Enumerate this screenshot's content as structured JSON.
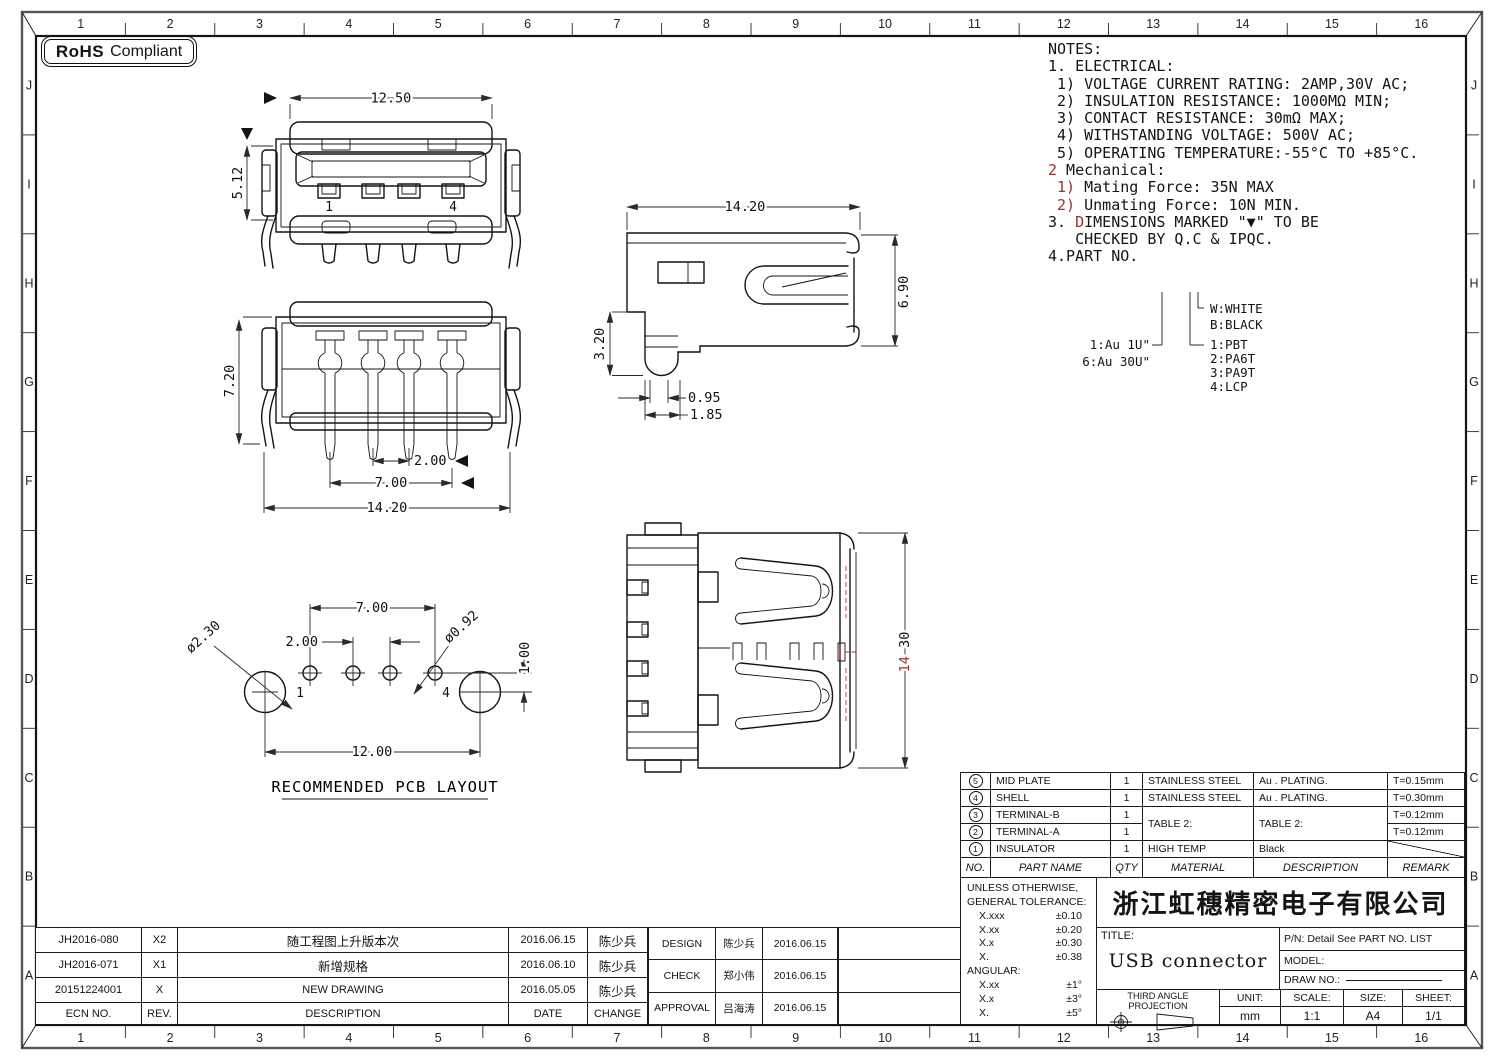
{
  "rohs": {
    "bold": "RoHS",
    "text": "Compliant"
  },
  "ruler": {
    "cols": [
      "1",
      "2",
      "3",
      "4",
      "5",
      "6",
      "7",
      "8",
      "9",
      "10",
      "11",
      "12",
      "13",
      "14",
      "15",
      "16"
    ],
    "rows": [
      "J",
      "I",
      "H",
      "G",
      "F",
      "E",
      "D",
      "C",
      "B",
      "A"
    ]
  },
  "notes": {
    "lines": [
      {
        "pre": "",
        "red": "",
        "text": "NOTES:"
      },
      {
        "pre": "",
        "red": "",
        "text": "1. ELECTRICAL:"
      },
      {
        "pre": "",
        "red": "",
        "text": " 1) VOLTAGE CURRENT RATING: 2AMP,30V AC;"
      },
      {
        "pre": "",
        "red": "",
        "text": " 2) INSULATION RESISTANCE: 1000MΩ MIN;"
      },
      {
        "pre": "",
        "red": "",
        "text": " 3) CONTACT RESISTANCE: 30mΩ MAX;"
      },
      {
        "pre": "",
        "red": "",
        "text": " 4) WITHSTANDING VOLTAGE: 500V AC;"
      },
      {
        "pre": "",
        "red": "",
        "text": " 5) OPERATING TEMPERATURE:-55°C TO +85°C."
      },
      {
        "pre": "",
        "red": "2",
        "text": " Mechanical:"
      },
      {
        "pre": " ",
        "red": "1)",
        "text": " Mating Force: 35N MAX"
      },
      {
        "pre": " ",
        "red": "2)",
        "text": " Unmating Force: 10N MIN."
      },
      {
        "pre": "3. ",
        "red": "D",
        "text": "IMENSIONS MARKED \"▼\" TO BE"
      },
      {
        "pre": "",
        "red": "",
        "text": "   CHECKED BY Q.C & IPQC."
      },
      {
        "pre": "",
        "red": "",
        "text": "4.PART NO."
      }
    ]
  },
  "part_tree": {
    "plating_options": [
      "1:Au 1U\"",
      "6:Au 30U\""
    ],
    "color_options": [
      "W:WHITE",
      "B:BLACK"
    ],
    "material_options": [
      "1:PBT",
      "2:PA6T",
      "3:PA9T",
      "4:LCP"
    ]
  },
  "views": {
    "front": {
      "dim_width": "12.50",
      "dim_height": "5.12",
      "pin_first": "1",
      "pin_last": "4"
    },
    "rear": {
      "dim_height": "7.20",
      "dim_pitch": "2.00",
      "dim_span": "7.00",
      "dim_width": "14.20"
    },
    "side": {
      "dim_width": "14.20",
      "dim_height": "6.90",
      "dim_leg": "3.20",
      "dim_tip": "0.95",
      "dim_leg_width": "1.85"
    },
    "top": {
      "dim_height_a": "14",
      "dim_height_b": " 30"
    },
    "pcb": {
      "dia_big": "ø2.30",
      "dia_small": "ø0.92",
      "dim_span": "7.00",
      "dim_pitch": "2.00",
      "dim_offset": "1.00",
      "dim_width": "12.00",
      "pin_first": "1",
      "pin_last": "4",
      "caption": "RECOMMENDED PCB LAYOUT"
    }
  },
  "parts_table": {
    "headers": {
      "no": "NO.",
      "part_name": "PART NAME",
      "qty": "QTY",
      "material": "MATERIAL",
      "description": "DESCRIPTION",
      "remark": "REMARK"
    },
    "rows": [
      {
        "no": "5",
        "name": "MID PLATE",
        "qty": "1",
        "material": "STAINLESS STEEL",
        "description": "Au . PLATING.",
        "remark": "T=0.15mm"
      },
      {
        "no": "4",
        "name": "SHELL",
        "qty": "1",
        "material": "STAINLESS STEEL",
        "description": "Au . PLATING.",
        "remark": "T=0.30mm"
      },
      {
        "no": "3",
        "name": "TERMINAL-B",
        "qty": "1",
        "material": "TABLE 2:",
        "description": "TABLE 2:",
        "remark": "T=0.12mm"
      },
      {
        "no": "2",
        "name": "TERMINAL-A",
        "qty": "1",
        "material": "",
        "description": "",
        "remark": "T=0.12mm"
      },
      {
        "no": "1",
        "name": "INSULATOR",
        "qty": "1",
        "material": "HIGH TEMP",
        "description": "Black",
        "remark": ""
      }
    ]
  },
  "tolerance_box": {
    "heading1": "UNLESS OTHERWISE,",
    "heading2": "GENERAL TOLERANCE:",
    "rows": [
      {
        "label": "X.xxx",
        "value": "±0.10"
      },
      {
        "label": "X.xx",
        "value": "±0.20"
      },
      {
        "label": "X.x",
        "value": "±0.30"
      },
      {
        "label": "X.",
        "value": "±0.38"
      }
    ],
    "angular_heading": "ANGULAR:",
    "angular_rows": [
      {
        "label": "X.xx",
        "value": "±1°"
      },
      {
        "label": "X.x",
        "value": "±3°"
      },
      {
        "label": "X.",
        "value": "±5°"
      }
    ]
  },
  "title_block": {
    "company": "浙江虹穗精密电子有限公司",
    "title_label": "TITLE:",
    "title": "USB connector",
    "pn": "P/N: Detail See PART NO. LIST",
    "model_label": "MODEL:",
    "draw_no_label": "DRAW NO.:",
    "projection": "THIRD ANGLE PROJECTION",
    "unit_label": "UNIT:",
    "unit": "mm",
    "scale_label": "SCALE:",
    "scale": "1:1",
    "size_label": "SIZE:",
    "size": "A4",
    "sheet_label": "SHEET:",
    "sheet": "1/1"
  },
  "revision_table": {
    "headers": [
      "ECN NO.",
      "REV.",
      "DESCRIPTION",
      "DATE",
      "CHANGE"
    ],
    "rows": [
      [
        "JH2016-080",
        "X2",
        "随工程图上升版本次",
        "2016.06.15",
        "陈少兵"
      ],
      [
        "JH2016-071",
        "X1",
        "新增规格",
        "2016.06.10",
        "陈少兵"
      ],
      [
        "20151224001",
        "X",
        "NEW DRAWING",
        "2016.05.05",
        "陈少兵"
      ]
    ]
  },
  "approval_table": {
    "rows": [
      [
        "DESIGN",
        "陈少兵",
        "2016.06.15"
      ],
      [
        "CHECK",
        "郑小伟",
        "2016.06.15"
      ],
      [
        "APPROVAL",
        "吕海涛",
        "2016.06.15"
      ]
    ]
  },
  "colors": {
    "line": "#141414",
    "red_accent": "#993030",
    "sheet": "#ffffff"
  }
}
